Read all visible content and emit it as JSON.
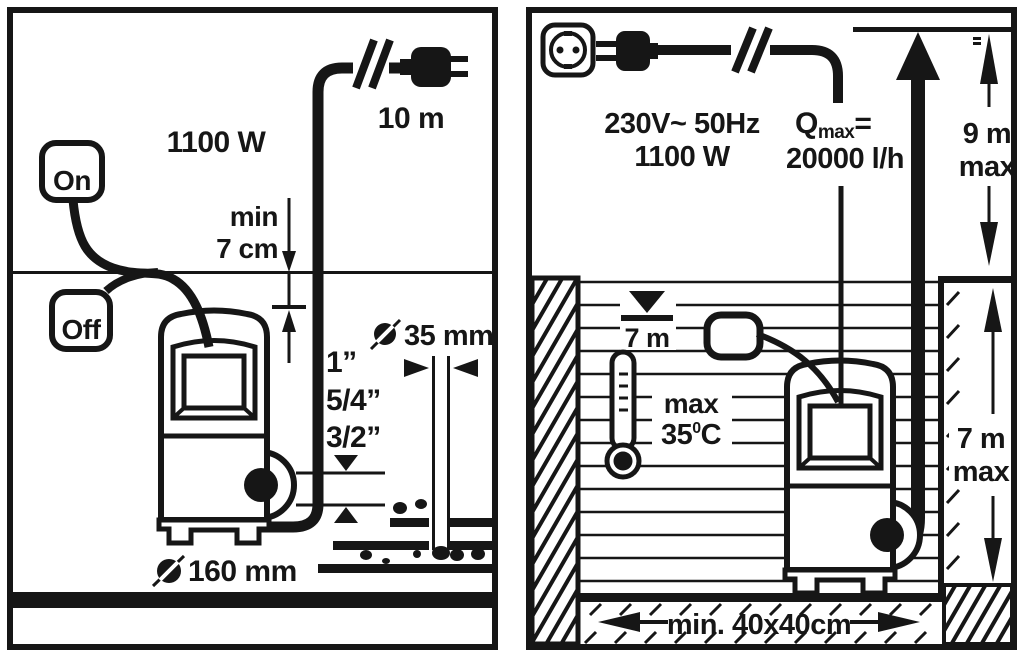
{
  "colors": {
    "ink": "#161616",
    "paper": "#ffffff"
  },
  "left_panel": {
    "power": "1100 W",
    "cable_length": "10 m",
    "switch_positions": {
      "on": "On",
      "off": "Off"
    },
    "min_water_depth": {
      "line1": "min",
      "line2": "7 cm"
    },
    "hose_sizes": [
      "1”",
      "5/4”",
      "3/2”"
    ],
    "outlet_pipe_diameter": "35 mm",
    "pump_base_diameter": "160 mm"
  },
  "right_panel": {
    "supply": {
      "voltage_freq": "230V~ 50Hz",
      "power": "1100 W"
    },
    "flow": {
      "symbol": "Q",
      "subscript": "max",
      "equals": "=",
      "value": "20000 l/h"
    },
    "delivery_head": {
      "value": "9 m",
      "qualifier": "max"
    },
    "water_depth_marker": "7 m",
    "max_temperature": {
      "qualifier": "max",
      "value": "35",
      "degree": "0",
      "unit": "C"
    },
    "immersion_depth": {
      "value": "7 m",
      "qualifier": "max"
    },
    "pit_min_size": "min. 40x40cm"
  }
}
